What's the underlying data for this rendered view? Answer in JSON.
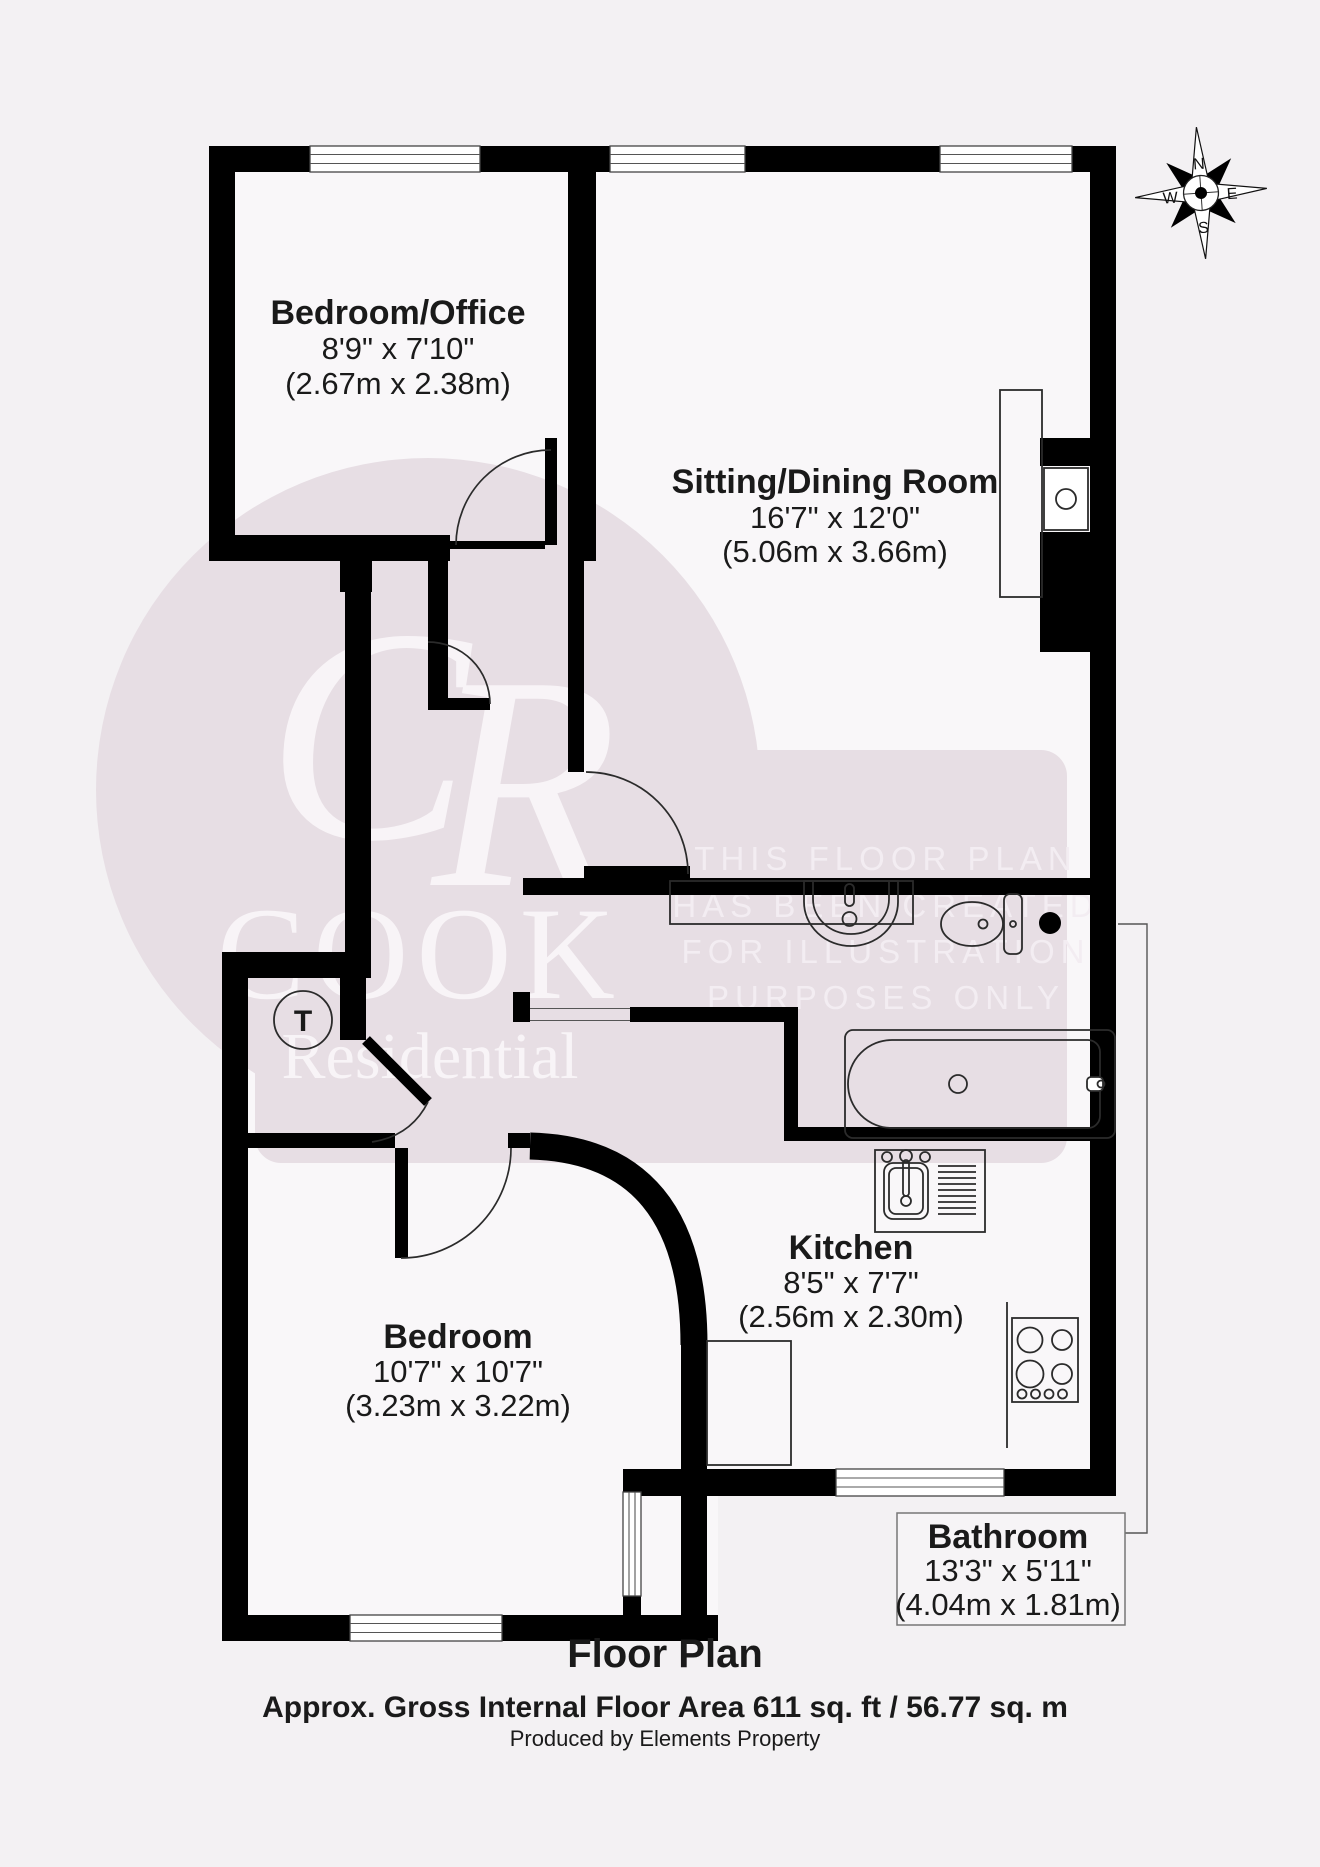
{
  "colors": {
    "bg": "#f3f1f3",
    "floor": "#f9f7f9",
    "wall": "#000000",
    "pink": "#e7dee4",
    "wm-text": "#f8f4f7",
    "notice": "#f3edf2",
    "line": "#2b2b2b",
    "ink": "#1a1a1a"
  },
  "rooms": [
    {
      "id": "bedroom-office",
      "name": "Bedroom/Office",
      "imperial": "8'9\" x 7'10\"",
      "metric": "(2.67m x 2.38m)"
    },
    {
      "id": "sitting-dining",
      "name": "Sitting/Dining Room",
      "imperial": "16'7\" x 12'0\"",
      "metric": "(5.06m x 3.66m)"
    },
    {
      "id": "bedroom",
      "name": "Bedroom",
      "imperial": "10'7\" x 10'7\"",
      "metric": "(3.23m x 3.22m)"
    },
    {
      "id": "kitchen",
      "name": "Kitchen",
      "imperial": "8'5\" x 7'7\"",
      "metric": "(2.56m x 2.30m)"
    },
    {
      "id": "bathroom",
      "name": "Bathroom",
      "imperial": "13'3\" x 5'11\"",
      "metric": "(4.04m x 1.81m)"
    }
  ],
  "fixtures": {
    "cupboard_label": "T",
    "names": [
      "bathtub",
      "toilet",
      "wash-basin",
      "vanity-counter",
      "kitchen-sink-drainer",
      "hob",
      "boiler",
      "sitting-room-counter",
      "hot-water-cylinder"
    ]
  },
  "compass": {
    "north": "N",
    "east": "E",
    "south": "S",
    "west": "W"
  },
  "watermark": {
    "monogram_c": "C",
    "monogram_r": "R",
    "brand_top": "COOK",
    "brand_bottom": "Residential",
    "notice_lines": [
      "THIS FLOOR PLAN",
      "HAS BEEN CREATED",
      "FOR ILLUSTRATION",
      "PURPOSES ONLY"
    ]
  },
  "footer": {
    "title": "Floor Plan",
    "area_text": "Approx. Gross Internal Floor Area 611 sq. ft / 56.77 sq. m",
    "produced_by": "Produced by Elements Property"
  }
}
